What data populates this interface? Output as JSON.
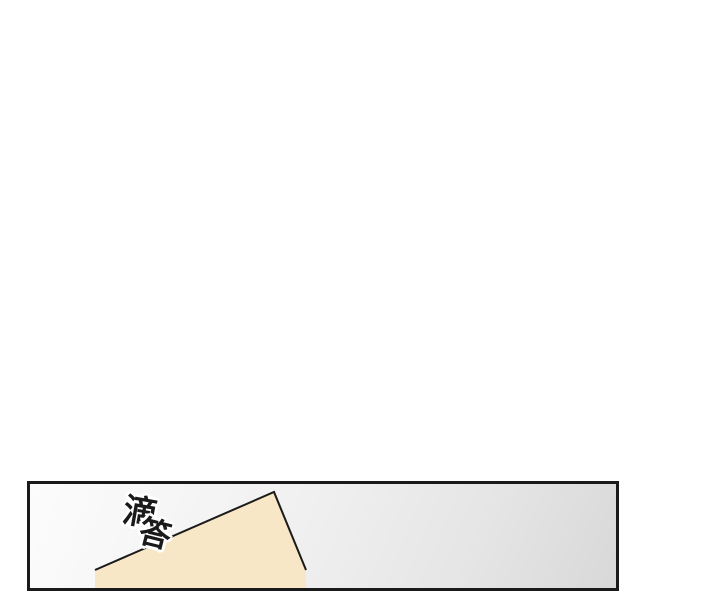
{
  "page": {
    "background_color": "#ffffff"
  },
  "panel": {
    "border_color": "#1a1a1a",
    "background_color_top_left": "#fcfcfc",
    "background_color_bottom_right": "#d9d8d9",
    "paper": {
      "fill_color": "#f8e7c6",
      "outline_color": "#1a1a1a"
    },
    "sfx": {
      "full_text": "滴答",
      "char_top": "滴",
      "char_bottom": "答",
      "text_color": "#1a1a1a",
      "halo_color": "#ffffff"
    }
  }
}
